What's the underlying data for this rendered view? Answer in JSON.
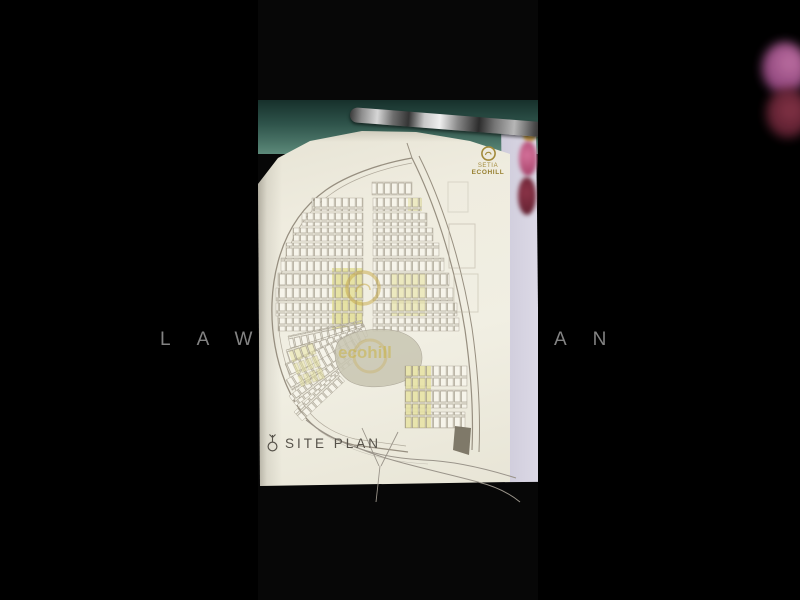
{
  "watermark": {
    "left": "LAW",
    "right": "AN"
  },
  "page": {
    "caption": "SITE PLAN",
    "brand_top": "SETIA",
    "brand_bottom": "ECOHILL",
    "center_watermark": "ecohill"
  },
  "colors": {
    "background": "#000000",
    "page_paper": "#efecdf",
    "brand_gold": "#a28a3a",
    "highlight_yellow": "#e4e09c",
    "desk_teal": "#2f544b",
    "sheet_lavender": "#d6d3e2",
    "watermark_grey": "#9a9a9a",
    "plan_line": "#978f80"
  }
}
